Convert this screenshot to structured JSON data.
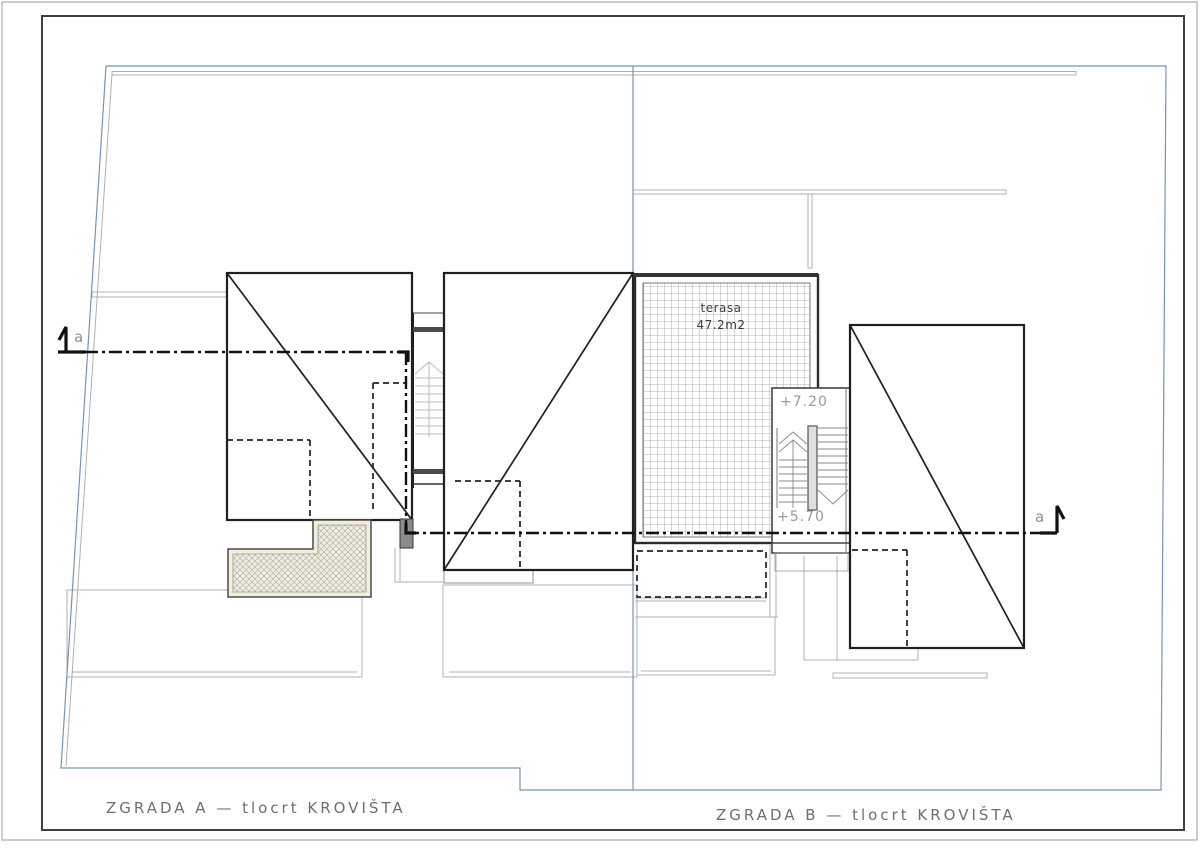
{
  "drawing": {
    "titles": {
      "zgrada_a": "ZGRADA A — tlocrt KROVIŠTA",
      "zgrada_b": "ZGRADA B — tlocrt KROVIŠTA"
    },
    "terrace": {
      "name": "terasa",
      "area": "47.2m2"
    },
    "levels": {
      "upper": "+7.20",
      "lower": "+5.70"
    },
    "section": {
      "left_label": "a",
      "right_label": "a"
    },
    "colors": {
      "parcel_blue": "#7494b8",
      "line_black": "#1f1f1f",
      "line_grey": "#b0b0b0",
      "text_grey": "#8f8f8f",
      "hatch_border_cream": "#f1eedb",
      "chimney_grey": "#8c8c8c",
      "frame_grey": "#3f3f3f"
    }
  }
}
